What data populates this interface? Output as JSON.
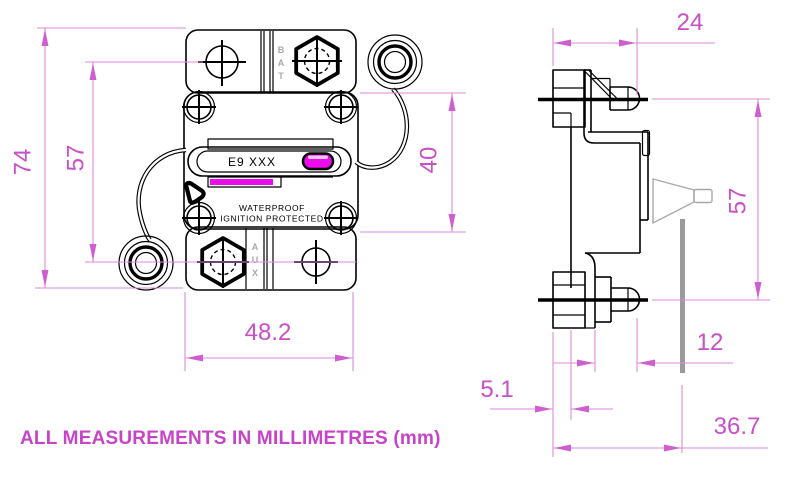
{
  "drawing": {
    "caption": "ALL MEASUREMENTS IN MILLIMETRES (mm)",
    "front_view": {
      "label_plate_text": "E9  XXX",
      "marking_line1": "WATERPROOF",
      "marking_line2": "IGNITION  PROTECTED",
      "terminal_top_letters": [
        "B",
        "A",
        "T"
      ],
      "terminal_bottom_letters": [
        "A",
        "U",
        "X"
      ],
      "dimensions": {
        "overall_height_mm": "74",
        "mount_hole_vertical_span_mm": "57",
        "body_screw_vertical_span_mm": "40",
        "mount_hole_horizontal_span_mm": "48.2"
      }
    },
    "side_view": {
      "dimensions": {
        "top_depth_mm": "24",
        "stud_vertical_span_mm": "57",
        "stud_length_mm": "12",
        "bracket_thickness_mm": "5.1",
        "overall_depth_mm": "36.7"
      }
    },
    "colors": {
      "dimension_line": "#de8ade",
      "dimension_text": "#c94fc9",
      "caption_text": "#c743c7",
      "highlight_magenta": "#ea0cea",
      "drawing_line": "#000000",
      "gray_detail": "#a8a8a8"
    }
  }
}
